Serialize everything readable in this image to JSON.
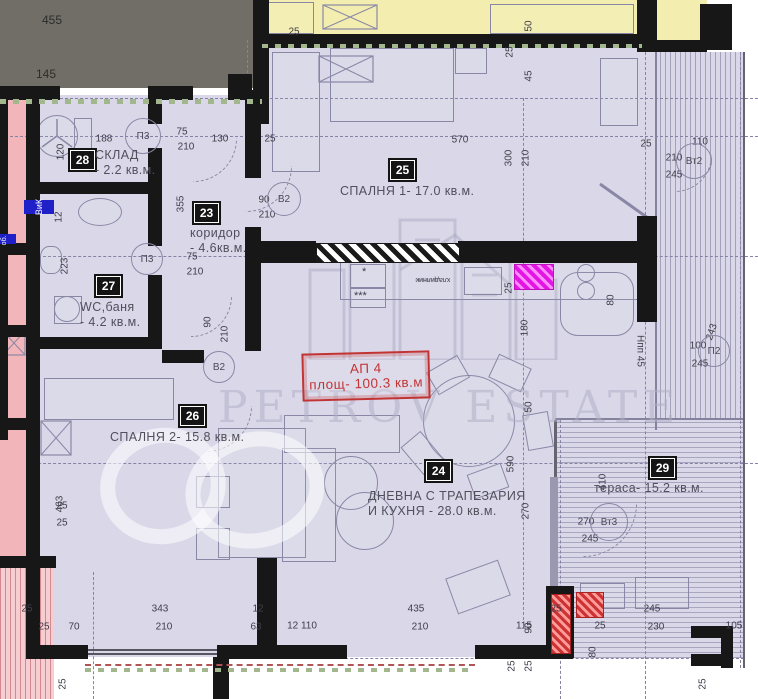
{
  "watermark": {
    "brand": "PETROV ESTATE"
  },
  "apartment_box": {
    "line1": "АП 4",
    "line2": "площ- 100.3 кв.м"
  },
  "rooms": [
    {
      "badge": "28",
      "name": "СКЛАД",
      "area": "- 2.2 кв.м.",
      "badge_x": 70,
      "badge_y": 150,
      "label_x": 95,
      "label_y": 148
    },
    {
      "badge": "23",
      "name": "коридор",
      "area": "- 4.6кв.м.",
      "badge_x": 194,
      "badge_y": 203,
      "label_x": 190,
      "label_y": 226
    },
    {
      "badge": "27",
      "name": "WC,баня",
      "area": "- 4.2 кв.м.",
      "badge_x": 96,
      "badge_y": 276,
      "label_x": 80,
      "label_y": 300
    },
    {
      "badge": "25",
      "name": "СПАЛНЯ 1- 17.0 кв.м.",
      "area": "",
      "badge_x": 390,
      "badge_y": 160,
      "label_x": 340,
      "label_y": 184
    },
    {
      "badge": "26",
      "name": "СПАЛНЯ 2- 15.8 кв.м.",
      "area": "",
      "badge_x": 180,
      "badge_y": 406,
      "label_x": 110,
      "label_y": 430
    },
    {
      "badge": "24",
      "name": "ДНЕВНА С ТРАПЕЗАРИЯ",
      "area": "И КУХНЯ - 28.0 кв.м.",
      "badge_x": 426,
      "badge_y": 461,
      "label_x": 368,
      "label_y": 489
    },
    {
      "badge": "29",
      "name": "тераса- 15.2 кв.м.",
      "area": "",
      "badge_x": 650,
      "badge_y": 458,
      "label_x": 594,
      "label_y": 481
    }
  ],
  "door_marks": [
    {
      "label": "П3",
      "x": 142,
      "y": 135,
      "r": 17
    },
    {
      "label": "П3",
      "x": 146,
      "y": 258,
      "r": 15
    },
    {
      "label": "В2",
      "x": 283,
      "y": 198,
      "r": 16
    },
    {
      "label": "В2",
      "x": 218,
      "y": 366,
      "r": 15
    },
    {
      "label": "Вт2",
      "x": 693,
      "y": 160,
      "r": 17
    },
    {
      "label": "П2",
      "x": 713,
      "y": 350,
      "r": 15
    },
    {
      "label": "Вт3",
      "x": 608,
      "y": 521,
      "r": 18
    }
  ],
  "dims": [
    [
      "455",
      40,
      14
    ],
    [
      "145",
      34,
      68
    ],
    [
      "188",
      92,
      133
    ],
    [
      "120",
      56,
      138,
      "v"
    ],
    [
      "75",
      170,
      126
    ],
    [
      "210",
      174,
      141
    ],
    [
      "130",
      208,
      133
    ],
    [
      "25",
      258,
      133
    ],
    [
      "25",
      282,
      26
    ],
    [
      "570",
      448,
      134
    ],
    [
      "25",
      505,
      38,
      "v"
    ],
    [
      "50",
      524,
      12,
      "v"
    ],
    [
      "45",
      524,
      62,
      "v"
    ],
    [
      "300",
      504,
      144,
      "v"
    ],
    [
      "210",
      521,
      144,
      "v"
    ],
    [
      "25",
      634,
      138
    ],
    [
      "110",
      688,
      136
    ],
    [
      "210",
      662,
      152
    ],
    [
      "245",
      662,
      169
    ],
    [
      "90",
      252,
      194
    ],
    [
      "210",
      255,
      209
    ],
    [
      "355",
      176,
      190,
      "v"
    ],
    [
      "75",
      180,
      251
    ],
    [
      "210",
      183,
      266
    ],
    [
      "12",
      54,
      203,
      "v"
    ],
    [
      "223",
      60,
      252,
      "v"
    ],
    [
      "90",
      203,
      308,
      "v"
    ],
    [
      "210",
      220,
      320,
      "v"
    ],
    [
      "25",
      504,
      274,
      "v"
    ],
    [
      "180",
      520,
      314,
      "v"
    ],
    [
      "80",
      606,
      286,
      "v"
    ],
    [
      "100",
      686,
      340
    ],
    [
      "245",
      688,
      358
    ],
    [
      "243",
      700,
      326,
      -72
    ],
    [
      "Нпп 45",
      628,
      345,
      90
    ],
    [
      "590",
      506,
      450,
      "v"
    ],
    [
      "270",
      521,
      497,
      "v"
    ],
    [
      "410",
      598,
      468,
      "v"
    ],
    [
      "270",
      574,
      516
    ],
    [
      "245",
      578,
      533
    ],
    [
      "463",
      55,
      490,
      "v"
    ],
    [
      "25",
      50,
      500
    ],
    [
      "25",
      50,
      517
    ],
    [
      "25",
      15,
      603
    ],
    [
      "25",
      32,
      621
    ],
    [
      "70",
      62,
      621
    ],
    [
      "343",
      148,
      603
    ],
    [
      "210",
      152,
      621
    ],
    [
      "12",
      246,
      603
    ],
    [
      "63",
      244,
      621
    ],
    [
      "12  110",
      290,
      620
    ],
    [
      "435",
      404,
      603
    ],
    [
      "210",
      408,
      621
    ],
    [
      "115",
      512,
      620
    ],
    [
      "90",
      524,
      614,
      "v"
    ],
    [
      "25",
      544,
      603
    ],
    [
      "25",
      588,
      620
    ],
    [
      "245",
      640,
      603
    ],
    [
      "230",
      644,
      621
    ],
    [
      "105",
      722,
      620
    ],
    [
      "80",
      588,
      638,
      "v"
    ],
    [
      "50",
      524,
      393,
      "v"
    ],
    [
      "25",
      507,
      652,
      "v"
    ],
    [
      "25",
      524,
      652,
      "v"
    ],
    [
      "25",
      58,
      670,
      "v"
    ],
    [
      "25",
      698,
      670,
      "v"
    ]
  ],
  "misc_labels": [
    {
      "text": "ВиК",
      "type": "badge",
      "x": 32,
      "y": 192,
      "w": 14,
      "h": 30
    },
    {
      "text": "ВиК об.",
      "type": "badge",
      "x": -4,
      "y": 224,
      "w": 10,
      "h": 30
    },
    {
      "text": "хладилник",
      "type": "rot180",
      "x": 416,
      "y": 276
    },
    {
      "text": "*",
      "type": "plain",
      "x": 362,
      "y": 266
    },
    {
      "text": "***",
      "type": "plain",
      "x": 354,
      "y": 290
    }
  ]
}
